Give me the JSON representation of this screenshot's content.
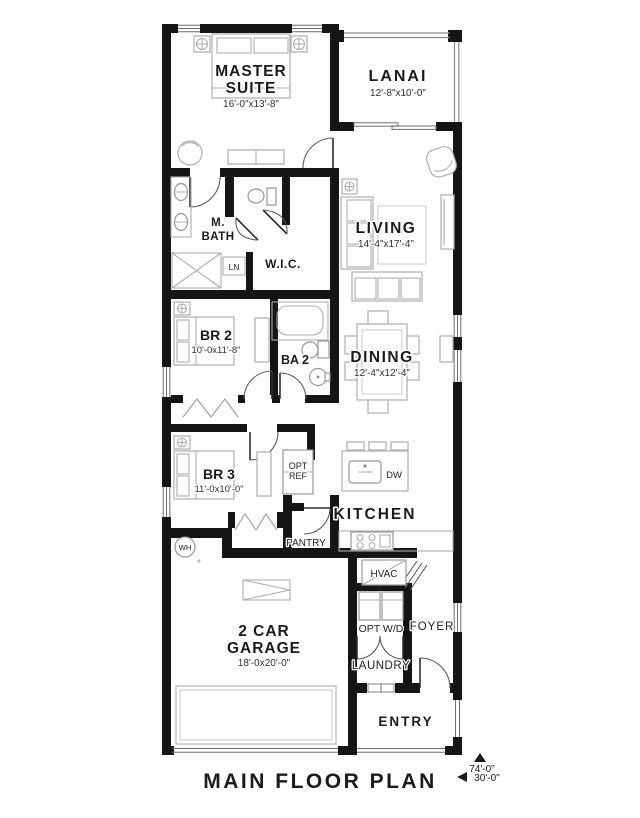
{
  "plan": {
    "title": "MAIN FLOOR PLAN",
    "dim_depth": "74'-0\"",
    "dim_width": "30'-0\""
  },
  "colors": {
    "wall": "#151515",
    "furniture_line": "#aeaeae",
    "text": "#1b1b1b",
    "background": "#ffffff"
  },
  "rooms": {
    "master_suite": {
      "line1": "MASTER",
      "line2": "SUITE",
      "dims": "16'-0\"x13'-8\""
    },
    "lanai": {
      "label": "LANAI",
      "dims": "12'-8\"x10'-0\""
    },
    "m_bath": {
      "line1": "M.",
      "line2": "BATH"
    },
    "wic": {
      "label": "W.I.C."
    },
    "linen": {
      "label": "LN"
    },
    "living": {
      "label": "LIVING",
      "dims": "14'-4\"x17'-4\""
    },
    "br2": {
      "label": "BR 2",
      "dims": "10'-0x11'-8\""
    },
    "ba2": {
      "label": "BA 2"
    },
    "dining": {
      "label": "DINING",
      "dims": "12'-4\"x12'-4\""
    },
    "br3": {
      "label": "BR 3",
      "dims": "11'-0x10'-0\""
    },
    "opt_ref": {
      "line1": "OPT",
      "line2": "REF"
    },
    "dw": {
      "label": "DW"
    },
    "kitchen": {
      "label": "KITCHEN"
    },
    "pantry": {
      "label": "PANTRY"
    },
    "wh": {
      "label": "WH"
    },
    "hvac": {
      "label": "HVAC"
    },
    "opt_wd": {
      "label": "OPT W/D"
    },
    "foyer": {
      "label": "FOYER"
    },
    "laundry": {
      "label": "LAUNDRY"
    },
    "garage": {
      "line1": "2 CAR",
      "line2": "GARAGE",
      "dims": "18'-0x20'-0\""
    },
    "entry": {
      "label": "ENTRY"
    }
  }
}
